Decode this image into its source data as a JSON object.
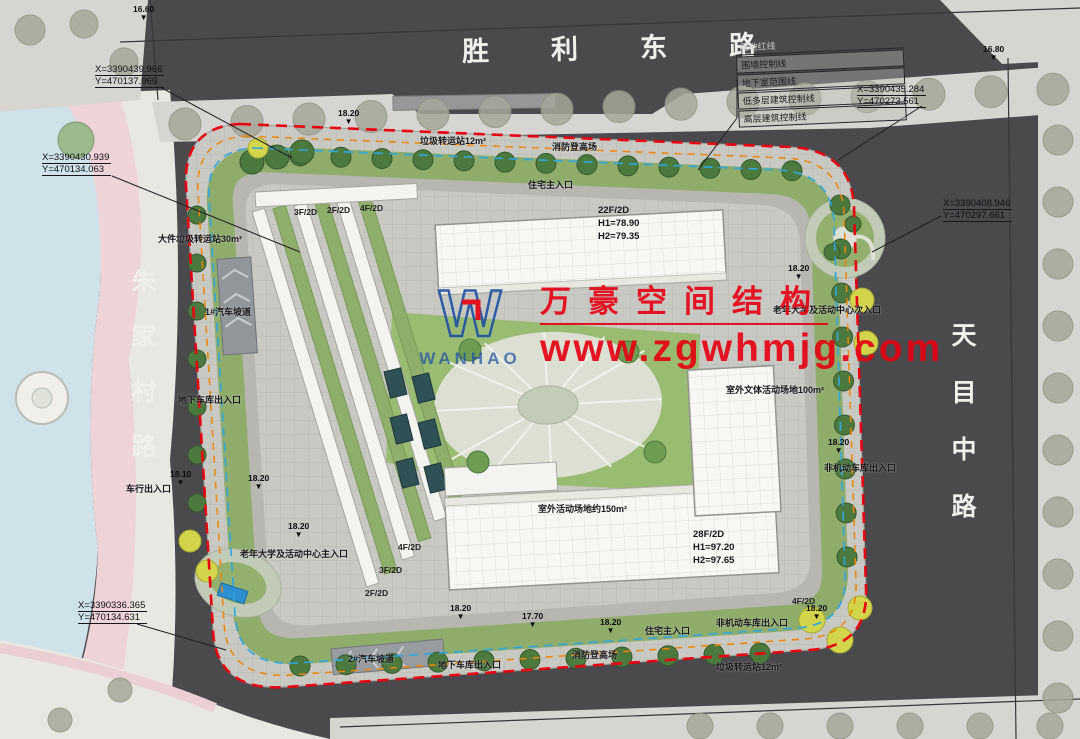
{
  "roads": {
    "top": "胜利东路",
    "left": "朱家村路",
    "right": "天目中路"
  },
  "legend": [
    "用地红线",
    "围墙控制线",
    "地下室范围线",
    "低多层建筑控制线",
    "高层建筑控制线"
  ],
  "coordinates": [
    {
      "x": "X=3390439.966",
      "y": "Y=470137.969"
    },
    {
      "x": "X=3390430.939",
      "y": "Y=470134.063"
    },
    {
      "x": "X=3390435.284",
      "y": "Y=470273.561"
    },
    {
      "x": "X=3390408.946",
      "y": "Y=470297.661"
    },
    {
      "x": "X=3390336.365",
      "y": "Y=470134.631"
    }
  ],
  "watermark": {
    "logo_letter": "W",
    "wordmark": "WANHAO",
    "company": "万豪空间结构",
    "website": "www.zgwhmjg.com"
  },
  "towers": [
    {
      "floors": "22F/2D",
      "h1": "H1=78.90",
      "h2": "H2=79.35"
    },
    {
      "floors": "28F/2D",
      "h1": "H1=97.20",
      "h2": "H2=97.65"
    }
  ],
  "annotations": [
    {
      "text": "垃圾转运站12m²",
      "x": 420,
      "y": 134
    },
    {
      "text": "消防登高场",
      "x": 552,
      "y": 140
    },
    {
      "text": "住宅主入口",
      "x": 528,
      "y": 178
    },
    {
      "text": "大件垃圾转运站30m²",
      "x": 158,
      "y": 232
    },
    {
      "text": "1#汽车坡道",
      "x": 205,
      "y": 305
    },
    {
      "text": "地下车库出入口",
      "x": 178,
      "y": 393
    },
    {
      "text": "车行出入口",
      "x": 126,
      "y": 482
    },
    {
      "text": "老年大学及活动中心主入口",
      "x": 240,
      "y": 547
    },
    {
      "text": "2#汽车坡道",
      "x": 348,
      "y": 652
    },
    {
      "text": "地下车库出入口",
      "x": 438,
      "y": 658
    },
    {
      "text": "消防登高场",
      "x": 572,
      "y": 648
    },
    {
      "text": "住宅主入口",
      "x": 645,
      "y": 624
    },
    {
      "text": "非机动车库出入口",
      "x": 716,
      "y": 616
    },
    {
      "text": "垃圾转运站12m²",
      "x": 716,
      "y": 660
    },
    {
      "text": "老年大学及活动中心次入口",
      "x": 773,
      "y": 303
    },
    {
      "text": "室外文体活动场地100m²",
      "x": 726,
      "y": 383
    },
    {
      "text": "非机动车库出入口",
      "x": 824,
      "y": 461
    },
    {
      "text": "室外活动场地约150m²",
      "x": 538,
      "y": 502
    }
  ],
  "wing_labels": [
    {
      "text": "3F/2D",
      "x": 294,
      "y": 207
    },
    {
      "text": "2F/2D",
      "x": 327,
      "y": 205
    },
    {
      "text": "4F/2D",
      "x": 360,
      "y": 203
    },
    {
      "text": "4F/2D",
      "x": 398,
      "y": 542
    },
    {
      "text": "3F/2D",
      "x": 379,
      "y": 565
    },
    {
      "text": "2F/2D",
      "x": 365,
      "y": 588
    },
    {
      "text": "4F/2D",
      "x": 792,
      "y": 596
    }
  ],
  "elevation_markers": [
    {
      "v": "16.60",
      "x": 133,
      "y": 5
    },
    {
      "v": "16.80",
      "x": 983,
      "y": 45
    },
    {
      "v": "18.20",
      "x": 338,
      "y": 109
    },
    {
      "v": "18.20",
      "x": 788,
      "y": 264
    },
    {
      "v": "18.20",
      "x": 828,
      "y": 438
    },
    {
      "v": "18.10",
      "x": 170,
      "y": 470
    },
    {
      "v": "18.20",
      "x": 248,
      "y": 474
    },
    {
      "v": "18.20",
      "x": 288,
      "y": 522
    },
    {
      "v": "18.20",
      "x": 450,
      "y": 604
    },
    {
      "v": "17.70",
      "x": 522,
      "y": 612
    },
    {
      "v": "18.20",
      "x": 600,
      "y": 618
    },
    {
      "v": "18.20",
      "x": 806,
      "y": 604
    }
  ],
  "colors": {
    "boundary_red": "#e60012",
    "control_orange": "#f08300",
    "basement_cyan": "#2ea7e0",
    "logo_blue": "#1d50a2",
    "watermark_red": "#e60012"
  }
}
